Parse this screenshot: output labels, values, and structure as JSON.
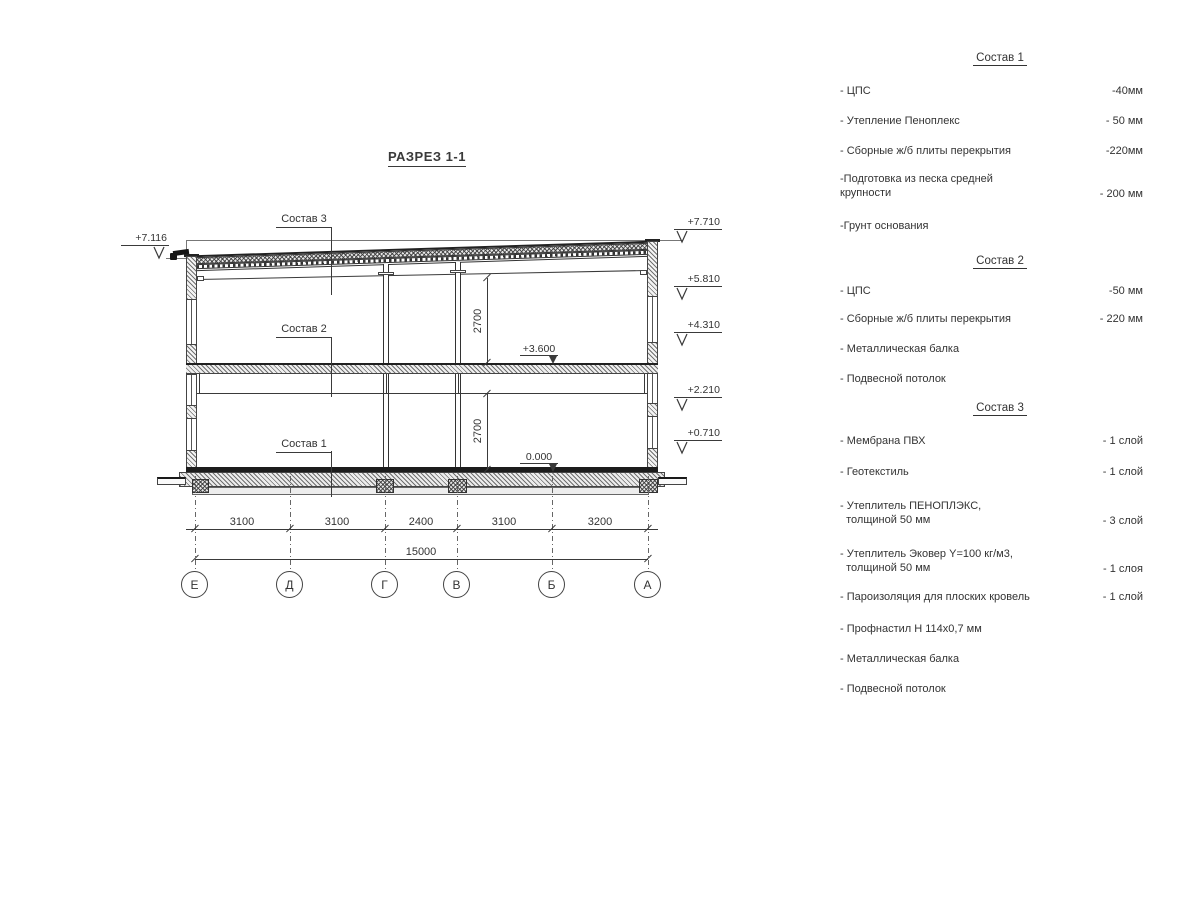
{
  "title": "РАЗРЕЗ 1-1",
  "drawing": {
    "comp_labels": {
      "c3": "Состав 3",
      "c2": "Состав 2",
      "c1": "Состав 1"
    },
    "levels_right": [
      "+7.710",
      "+5.810",
      "+4.310",
      "+2.210",
      "+0.710"
    ],
    "level_left": "+7.116",
    "level_mid_upper": "+3.600",
    "level_mid_lower": "0.000",
    "room_heights": [
      "2700",
      "2700"
    ],
    "dim_segments": [
      "3100",
      "3100",
      "2400",
      "3100",
      "3200"
    ],
    "dim_total": "15000",
    "axes": [
      "Е",
      "Д",
      "Г",
      "В",
      "Б",
      "А"
    ]
  },
  "materials": {
    "s1": {
      "heading": "Состав 1",
      "items": [
        {
          "name": "- ЦПС",
          "value": "-40мм"
        },
        {
          "name": "- Утепление Пеноплекс",
          "value": "- 50 мм"
        },
        {
          "name": "- Сборные ж/б плиты перекрытия",
          "value": "-220мм"
        },
        {
          "name": "-Подготовка из песка средней\nкрупности",
          "value": "- 200 мм"
        },
        {
          "name": "-Грунт основания",
          "value": ""
        }
      ]
    },
    "s2": {
      "heading": "Состав 2",
      "items": [
        {
          "name": "- ЦПС",
          "value": "-50 мм"
        },
        {
          "name": "- Сборные ж/б плиты перекрытия",
          "value": "- 220 мм"
        },
        {
          "name": "- Металлическая балка",
          "value": ""
        },
        {
          "name": "- Подвесной потолок",
          "value": ""
        }
      ]
    },
    "s3": {
      "heading": "Состав 3",
      "items": [
        {
          "name": "- Мембрана ПВХ",
          "value": "- 1 слой"
        },
        {
          "name": "- Геотекстиль",
          "value": "- 1 слой"
        },
        {
          "name": "- Утеплитель ПЕНОПЛЭКС,\n  толщиной 50 мм",
          "value": "- 3 слой"
        },
        {
          "name": "- Утеплитель Эковер Y=100 кг/м3,\n  толщиной 50 мм",
          "value": "- 1 слоя"
        },
        {
          "name": "- Пароизоляция для плоских кровель",
          "value": "- 1 слой"
        },
        {
          "name": "- Профнастил Н 114х0,7 мм",
          "value": ""
        },
        {
          "name": "- Металлическая балка",
          "value": ""
        },
        {
          "name": "- Подвесной потолок",
          "value": ""
        }
      ]
    }
  }
}
